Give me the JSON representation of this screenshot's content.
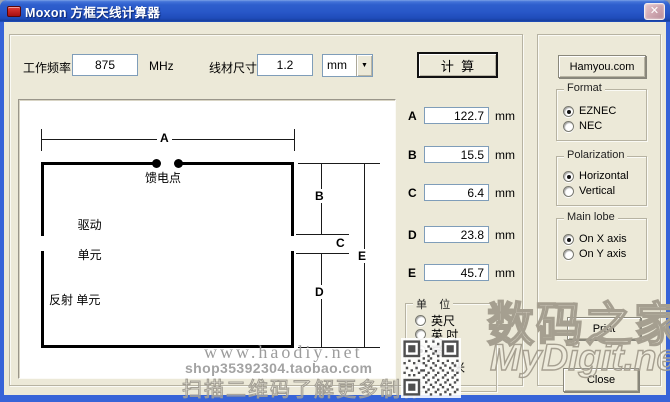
{
  "window": {
    "title": "Moxon 方框天线计算器"
  },
  "icons": {
    "close": "✕",
    "dropdown": "▼"
  },
  "toolbar": {
    "freq_label": "工作频率",
    "freq_value": "875",
    "freq_unit": "MHz",
    "wire_label": "线材尺寸",
    "wire_value": "1.2",
    "wire_unit_selected": "mm",
    "calc_label": "计  算"
  },
  "diagram": {
    "dim_a": "A",
    "dim_b": "B",
    "dim_c": "C",
    "dim_d": "D",
    "dim_e": "E",
    "feed_label": "馈电点",
    "driven_label_line1": "驱动",
    "driven_label_line2": "单元",
    "reflector_label": "反射 单元"
  },
  "results": {
    "rows": [
      {
        "label": "A",
        "value": "122.7",
        "unit": "mm"
      },
      {
        "label": "B",
        "value": "15.5",
        "unit": "mm"
      },
      {
        "label": "C",
        "value": "6.4",
        "unit": "mm"
      },
      {
        "label": "D",
        "value": "23.8",
        "unit": "mm"
      },
      {
        "label": "E",
        "value": "45.7",
        "unit": "mm"
      }
    ]
  },
  "unit_group": {
    "title": "单    位",
    "options": [
      {
        "label": "英尺",
        "selected": false
      },
      {
        "label": "英 吋",
        "selected": false
      },
      {
        "label": "毫 米",
        "selected": true
      },
      {
        "label": "米",
        "selected": false
      }
    ]
  },
  "side_panel": {
    "website_button": "Hamyou.com",
    "format": {
      "title": "Format",
      "options": [
        {
          "label": "EZNEC",
          "selected": true
        },
        {
          "label": "NEC",
          "selected": false
        }
      ]
    },
    "polarization": {
      "title": "Polarization",
      "options": [
        {
          "label": "Horizontal",
          "selected": true
        },
        {
          "label": "Vertical",
          "selected": false
        }
      ]
    },
    "main_lobe": {
      "title": "Main lobe",
      "options": [
        {
          "label": "On X axis",
          "selected": true
        },
        {
          "label": "On Y axis",
          "selected": false
        }
      ]
    },
    "print_button": "Print",
    "close_button": "Close"
  },
  "watermarks": {
    "line1": "www.haodiy.net",
    "line2": "shop35392304.taobao.com",
    "line3": "扫描二维码了解更多制作",
    "brand_cn": "数码之家",
    "brand_en": "MyDigit.net"
  }
}
